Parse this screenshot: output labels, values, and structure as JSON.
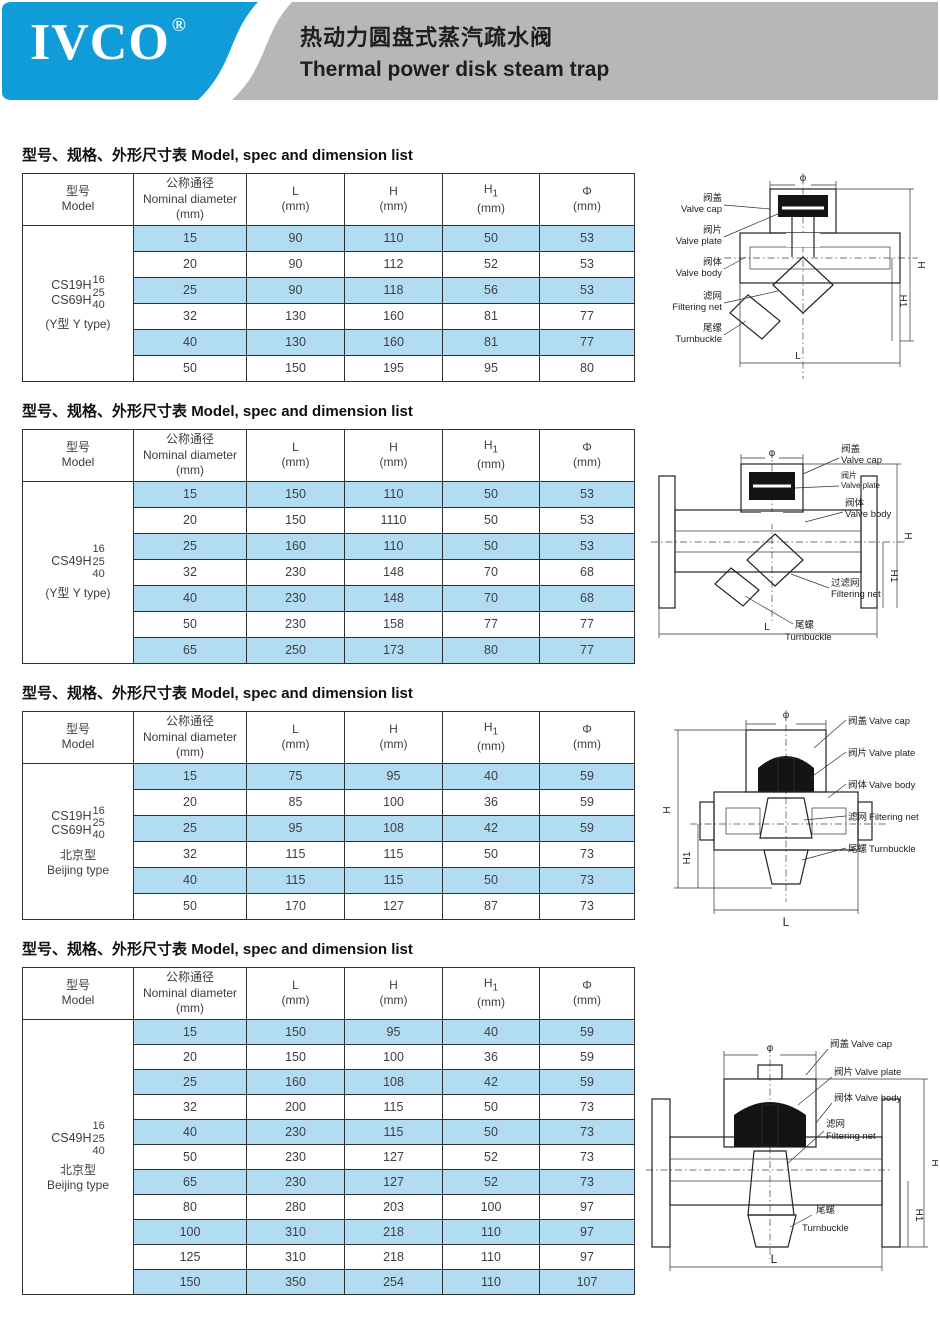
{
  "header": {
    "logo": "IVCO",
    "reg_mark": "®",
    "title_zh": "热动力圆盘式蒸汽疏水阀",
    "title_en": "Thermal power disk steam trap"
  },
  "colors": {
    "brand_blue": "#0f9cd8",
    "banner_gray": "#b6b7b9",
    "row_blue": "#b2dcf2"
  },
  "section_title": {
    "zh": "型号、规格、外形尺寸表",
    "en": "Model, spec and dimension list"
  },
  "table_headers": {
    "model_zh": "型号",
    "model_en": "Model",
    "dn_zh": "公称通径",
    "dn_en": "Nominal diameter",
    "unit_mm": "(mm)",
    "col_l": "L",
    "col_h": "H",
    "col_h1_base": "H",
    "col_h1_sub": "1",
    "col_phi": "Φ"
  },
  "tables": [
    {
      "model_names": [
        "CS19H",
        "CS69H"
      ],
      "model_nums": [
        "16",
        "25",
        "40"
      ],
      "model_type_lines": [
        "(Y型 Y type)"
      ],
      "rows": [
        [
          "15",
          "90",
          "110",
          "50",
          "53"
        ],
        [
          "20",
          "90",
          "112",
          "52",
          "53"
        ],
        [
          "25",
          "90",
          "118",
          "56",
          "53"
        ],
        [
          "32",
          "130",
          "160",
          "81",
          "77"
        ],
        [
          "40",
          "130",
          "160",
          "81",
          "77"
        ],
        [
          "50",
          "150",
          "195",
          "95",
          "80"
        ]
      ]
    },
    {
      "model_names": [
        "CS49H"
      ],
      "model_nums": [
        "16",
        "25",
        "40"
      ],
      "model_type_lines": [
        "(Y型 Y type)"
      ],
      "rows": [
        [
          "15",
          "150",
          "110",
          "50",
          "53"
        ],
        [
          "20",
          "150",
          "1110",
          "50",
          "53"
        ],
        [
          "25",
          "160",
          "110",
          "50",
          "53"
        ],
        [
          "32",
          "230",
          "148",
          "70",
          "68"
        ],
        [
          "40",
          "230",
          "148",
          "70",
          "68"
        ],
        [
          "50",
          "230",
          "158",
          "77",
          "77"
        ],
        [
          "65",
          "250",
          "173",
          "80",
          "77"
        ]
      ]
    },
    {
      "model_names": [
        "CS19H",
        "CS69H"
      ],
      "model_nums": [
        "16",
        "25",
        "40"
      ],
      "model_type_lines": [
        "北京型",
        "Beijing type"
      ],
      "rows": [
        [
          "15",
          "75",
          "95",
          "40",
          "59"
        ],
        [
          "20",
          "85",
          "100",
          "36",
          "59"
        ],
        [
          "25",
          "95",
          "108",
          "42",
          "59"
        ],
        [
          "32",
          "115",
          "115",
          "50",
          "73"
        ],
        [
          "40",
          "115",
          "115",
          "50",
          "73"
        ],
        [
          "50",
          "170",
          "127",
          "87",
          "73"
        ]
      ]
    },
    {
      "model_names": [
        "CS49H"
      ],
      "model_nums": [
        "16",
        "25",
        "40"
      ],
      "model_type_lines": [
        "北京型",
        "Beijing type"
      ],
      "rows": [
        [
          "15",
          "150",
          "95",
          "40",
          "59"
        ],
        [
          "20",
          "150",
          "100",
          "36",
          "59"
        ],
        [
          "25",
          "160",
          "108",
          "42",
          "59"
        ],
        [
          "32",
          "200",
          "115",
          "50",
          "73"
        ],
        [
          "40",
          "230",
          "115",
          "50",
          "73"
        ],
        [
          "50",
          "230",
          "127",
          "52",
          "73"
        ],
        [
          "65",
          "230",
          "127",
          "52",
          "73"
        ],
        [
          "80",
          "280",
          "203",
          "100",
          "97"
        ],
        [
          "100",
          "310",
          "218",
          "110",
          "97"
        ],
        [
          "125",
          "310",
          "218",
          "110",
          "97"
        ],
        [
          "150",
          "350",
          "254",
          "110",
          "107"
        ]
      ]
    }
  ],
  "diagrams": [
    {
      "cap_zh": "阀盖",
      "cap_en": "Valve cap",
      "plate_zh": "阀片",
      "plate_en": "Valve plate",
      "body_zh": "阀体",
      "body_en": "Valve body",
      "net_zh": "滤网",
      "net_en": "Filtering net",
      "turn_zh": "尾缧",
      "turn_en": "Turnbuckle",
      "dim_phi": "φ",
      "dim_h": "H",
      "dim_h1": "H1",
      "dim_l": "L"
    },
    {
      "cap_zh": "阀盖",
      "cap_en": "Valve cap",
      "plate_zh": "阀片",
      "plate_en": "Valve plate",
      "body_zh": "阀体",
      "body_en": "Valve body",
      "net_zh": "过滤网",
      "net_en": "Filtering net",
      "turn_zh": "尾螺",
      "turn_en": "Turnbuckle",
      "dim_phi": "φ",
      "dim_h": "H",
      "dim_h1": "H1",
      "dim_l": "L"
    },
    {
      "cap_zh": "阀盖",
      "cap_en": "Valve cap",
      "plate_zh": "阀片",
      "plate_en": "Valve plate",
      "body_zh": "阀体",
      "body_en": "Valve body",
      "net_zh": "滤网",
      "net_en": "Filtering net",
      "turn_zh": "尾螺",
      "turn_en": "Turnbuckle",
      "dim_phi": "φ",
      "dim_h": "H",
      "dim_h1": "H1",
      "dim_l": "L"
    },
    {
      "cap_zh": "阀盖",
      "cap_en": "Valve cap",
      "plate_zh": "阀片",
      "plate_en": "Valve plate",
      "body_zh": "阀体",
      "body_en": "Valve body",
      "net_zh": "滤网",
      "net_en": "Filtering net",
      "turn_zh": "尾螺",
      "turn_en": "Turnbuckle",
      "dim_phi": "φ",
      "dim_h": "H",
      "dim_h1": "H1",
      "dim_l": "L"
    }
  ]
}
